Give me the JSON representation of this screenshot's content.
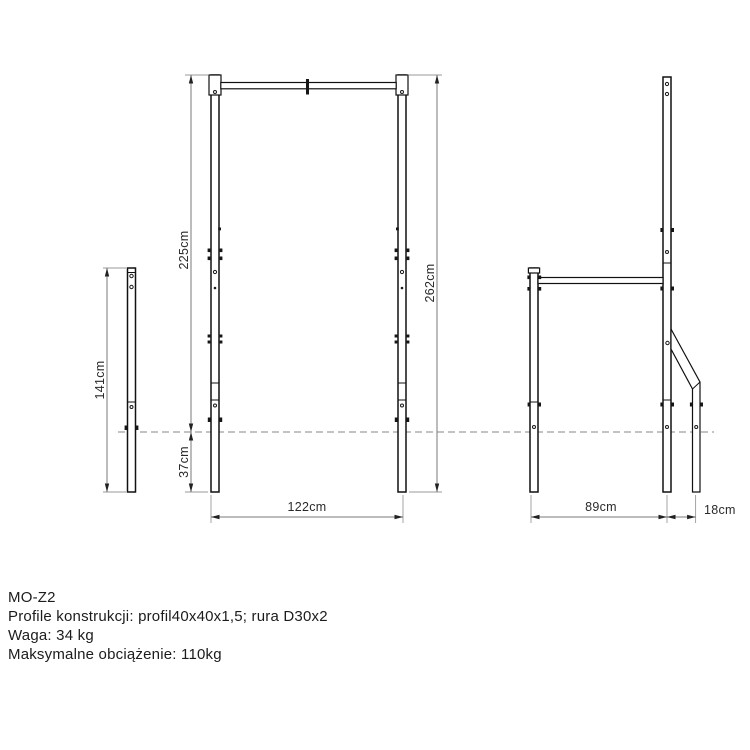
{
  "drawing": {
    "dims": {
      "left_post_height": "141cm",
      "frame_height_above_ground": "225cm",
      "underground_depth": "37cm",
      "frame_total_height": "262cm",
      "frame_width": "122cm",
      "side_depth": "89cm",
      "rear_brace_offset": "18cm"
    }
  },
  "info": {
    "model": "MO-Z2",
    "profiles": "Profile konstrukcji: profil40x40x1,5; rura D30x2",
    "weight": "Waga: 34 kg",
    "max_load": "Maksymalne obciążenie: 110kg"
  },
  "colors": {
    "structure_line": "#111111",
    "dimension_line": "#7a7a7a",
    "ground_line": "#878787",
    "text": "#1c1c1c",
    "background": "#ffffff"
  }
}
